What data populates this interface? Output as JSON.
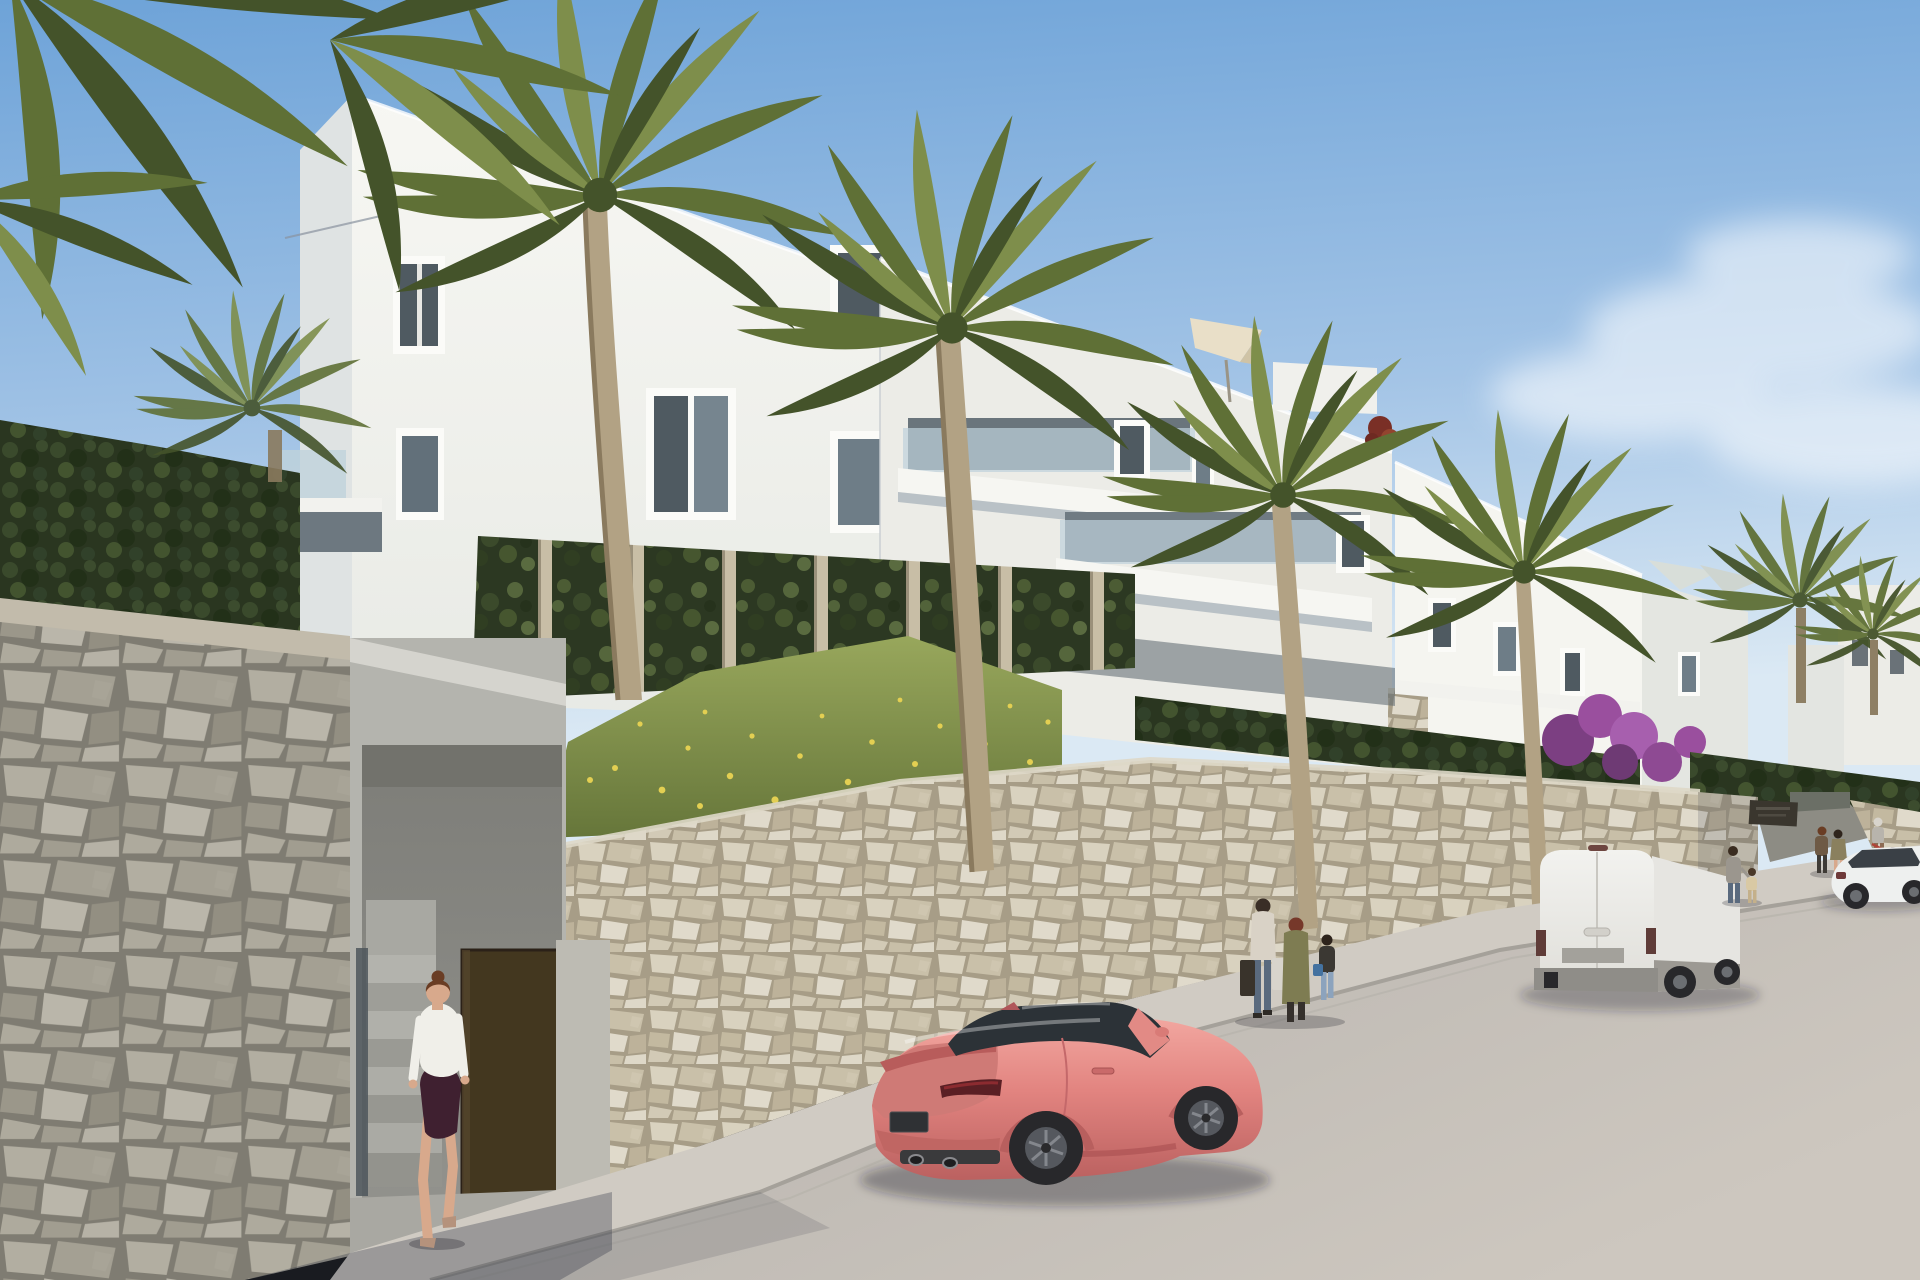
{
  "scene": {
    "type": "architectural-render",
    "objects": {
      "buildings": [
        "white-apartment-building-left",
        "white-apartment-building-middle",
        "white-apartment-building-right",
        "distant-white-houses"
      ],
      "vegetation": [
        "palm-trees",
        "boxwood-hedge",
        "ivy-green-wall",
        "grass-slope-with-yellow-wildflowers",
        "purple-bougainvillea"
      ],
      "hardscape": [
        "foreground-stone-retaining-wall",
        "street-stone-retaining-wall",
        "pedestrian-entrance-with-stairs",
        "driveway-entrance",
        "sidewalk",
        "street"
      ],
      "vehicles": [
        "pink-sports-coupe",
        "white-panel-van",
        "white-sedan"
      ],
      "people": [
        "woman-entering-stairs",
        "two-women-with-child",
        "man-with-child",
        "couple-standing",
        "person-with-bicycle"
      ],
      "signage": [
        "dark-entrance-plaque-unreadable"
      ]
    }
  },
  "colors": {
    "sky_top": "#6ea3d8",
    "sky_mid": "#a3c4e6",
    "sky_horizon": "#dbe9f4",
    "cloud_white": "#ffffff",
    "building_lit": "#f5f5f0",
    "building_mid": "#ecece7",
    "building_shade": "#dfe3e3",
    "building_dark_band": "#5b666d",
    "window_glass": "#4f5a61",
    "balcony_glass": "#bfd2db",
    "frame_white": "#fbfbf8",
    "stone_grout_sun": "#a79d87",
    "stone_grout_shade": "#7f7c72",
    "concrete_light": "#d5d4ce",
    "concrete_mid": "#b4b4ae",
    "recess_grey": "#93938e",
    "door_brown": "#43371f",
    "plaque_dark": "#3a362e",
    "ivy_base": "#2c3822",
    "hedge_base": "#2a3620",
    "grass_top": "#98a75c",
    "grass_bottom": "#66763a",
    "flower_yellow": "#e3cf52",
    "palm_base": "#5f7036",
    "palm_dark": "#44532a",
    "palm_light": "#7e8e4b",
    "trunk": "#b2a284",
    "trunk_shade": "#8a7a5e",
    "bougainvillea": "#9a4f9e",
    "road": "#b5b1ac",
    "road_light": "#cdc7bf",
    "sidewalk": "#d0cbc3",
    "curb": "#a5a19a",
    "car_pink": "#e28480",
    "car_pink_light": "#f2a7a0",
    "car_pink_dark": "#bb6160",
    "car_glass": "#2c3237",
    "van_body": "#f2f2ef",
    "van_trim": "#9c9993",
    "sedan_body": "#eef0ef",
    "wheel_dark": "#28282b",
    "rim_grey": "#6b6e72",
    "skin": "#d8a98c",
    "shirt_white": "#f0efe9",
    "skirt_maroon": "#3f2030",
    "hair_brown": "#6a3d24",
    "jeans_blue": "#5a6a7e",
    "olive_jacket": "#7e7c52"
  }
}
